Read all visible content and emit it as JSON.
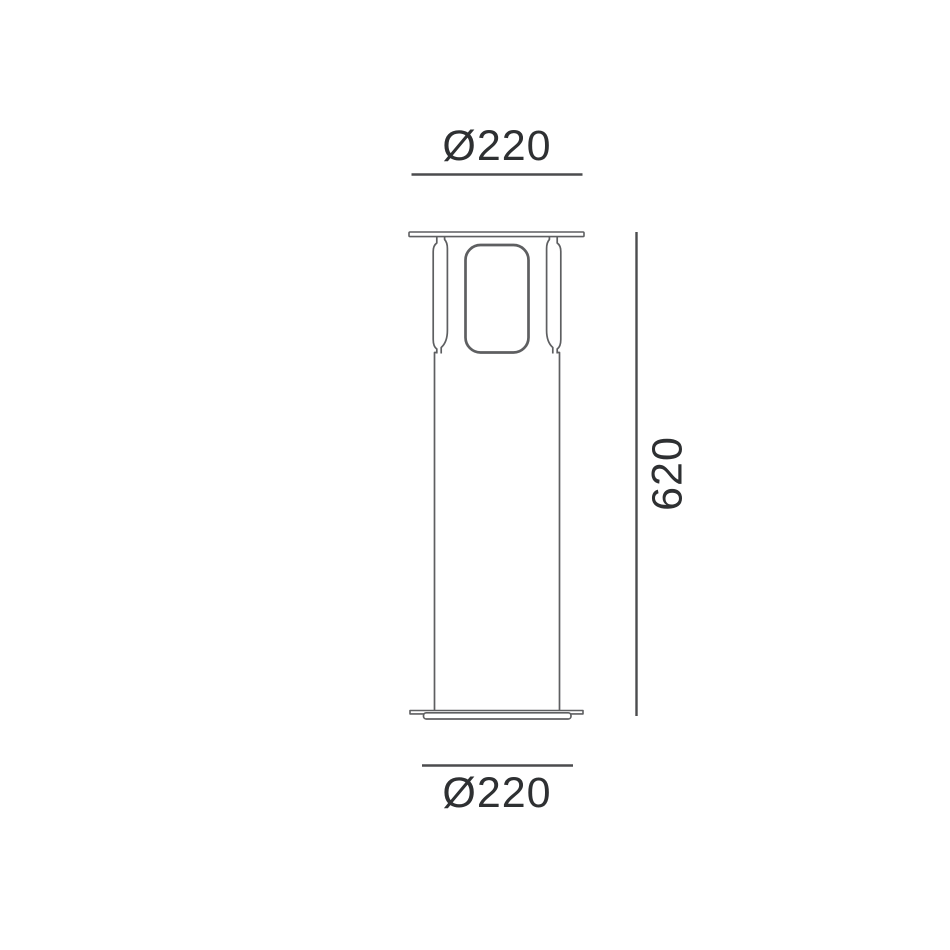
{
  "drawing": {
    "subject": "bollard luminaire - front elevation dimension drawing",
    "colors": {
      "background": "#ffffff",
      "outline": "#5e5f61",
      "dimension_line": "#4b4c4e",
      "text": "#2e3032"
    },
    "dimensions": {
      "top_diameter": {
        "label": "Ø220",
        "value": 220,
        "position": "top",
        "axis": "horizontal"
      },
      "height": {
        "label": "620",
        "value": 620,
        "position": "right",
        "axis": "vertical"
      },
      "bottom_diameter": {
        "label": "Ø220",
        "value": 220,
        "position": "bottom",
        "axis": "horizontal"
      }
    }
  }
}
